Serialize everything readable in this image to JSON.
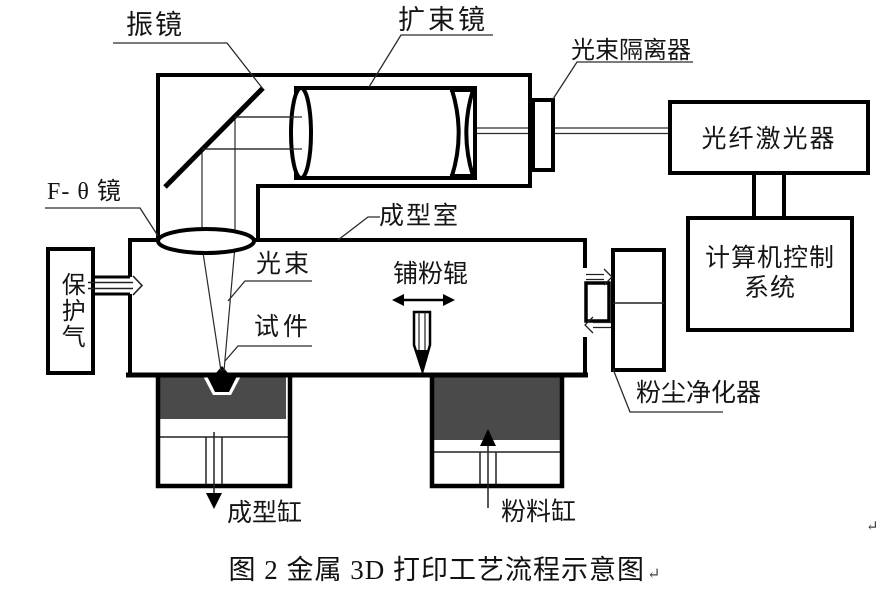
{
  "diagram": {
    "labels": {
      "galvanometer": "振镜",
      "beam_expander": "扩束镜",
      "beam_isolator": "光束隔离器",
      "fiber_laser": "光纤激光器",
      "computer_control_line1": "计算机控制",
      "computer_control_line2": "系统",
      "f_theta_lens": "F- θ 镜",
      "forming_chamber": "成型室",
      "light_beam": "光束",
      "powder_roller": "铺粉辊",
      "specimen": "试件",
      "protective_gas": "保护气",
      "dust_purifier": "粉尘净化器",
      "forming_cylinder": "成型缸",
      "powder_cylinder": "粉料缸"
    },
    "caption": "图 2 金属 3D 打印工艺流程示意图",
    "return_mark": "↵",
    "colors": {
      "line": "#000000",
      "thin_line": "#2a2a2a",
      "powder_fill": "#4a4a4a",
      "background": "#ffffff"
    }
  }
}
